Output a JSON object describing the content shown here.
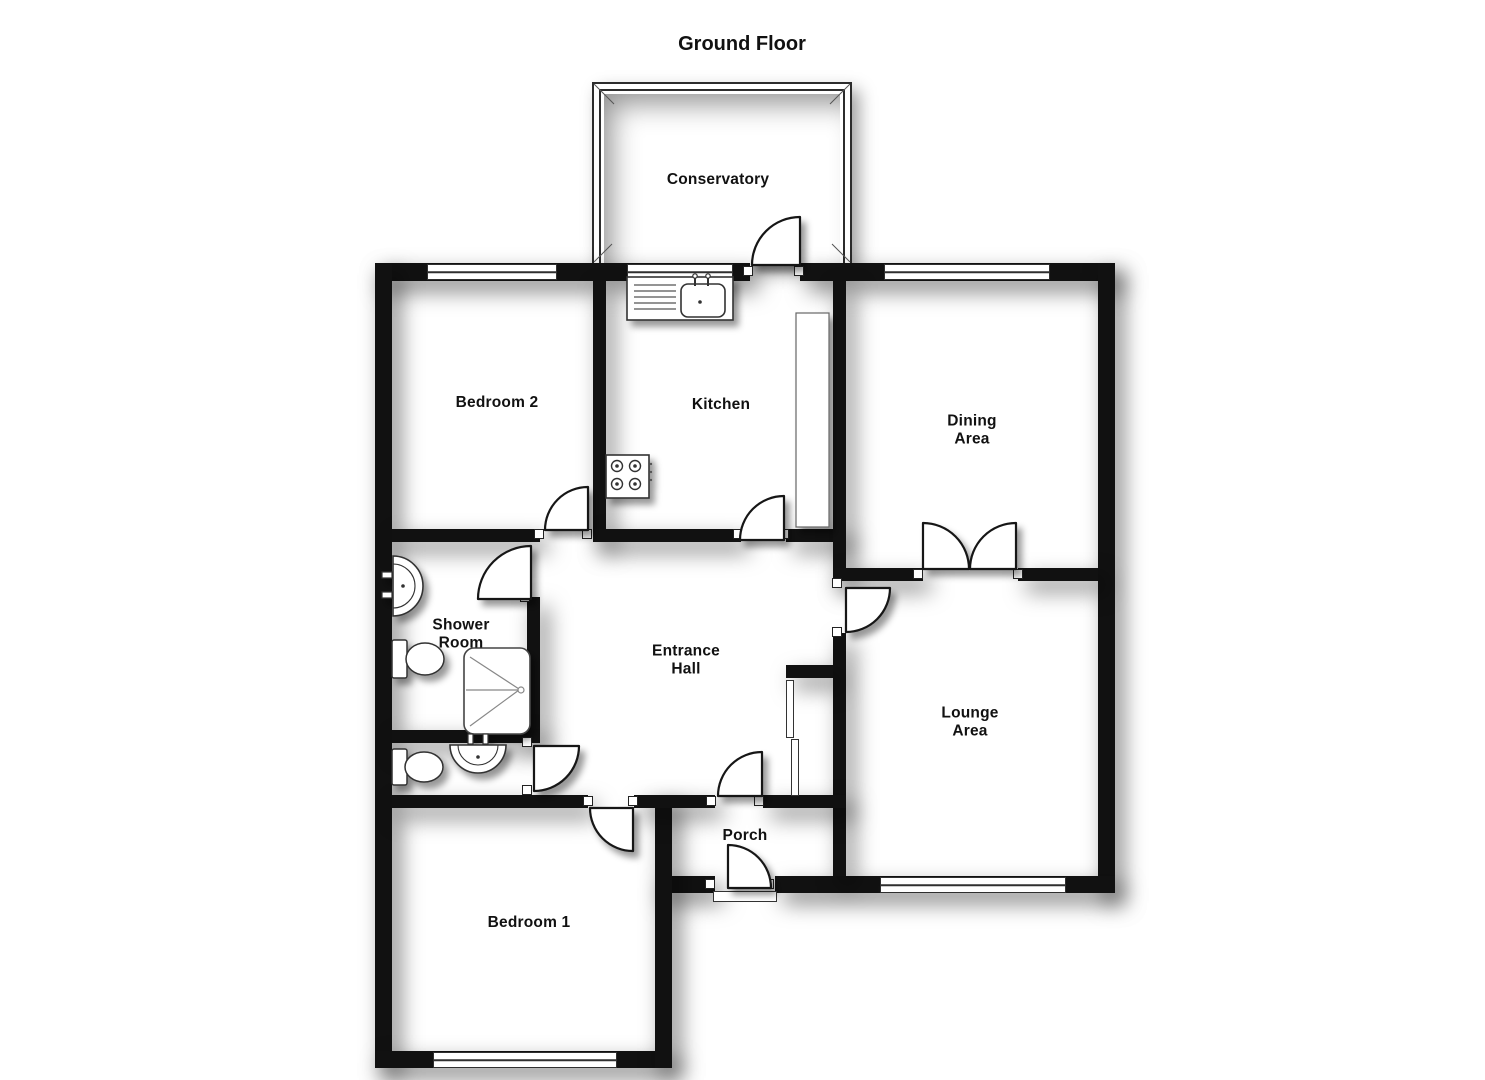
{
  "title": "Ground Floor",
  "plan": {
    "rooms": [
      {
        "name": "conservatory",
        "label": "Conservatory"
      },
      {
        "name": "bedroom-2",
        "label": "Bedroom 2"
      },
      {
        "name": "kitchen",
        "label": "Kitchen"
      },
      {
        "name": "dining-area",
        "label": "Dining\nArea"
      },
      {
        "name": "shower-room",
        "label": "Shower\nRoom"
      },
      {
        "name": "entrance-hall",
        "label": "Entrance\nHall"
      },
      {
        "name": "lounge-area",
        "label": "Lounge\nArea"
      },
      {
        "name": "porch",
        "label": "Porch"
      },
      {
        "name": "bedroom-1",
        "label": "Bedroom 1"
      }
    ],
    "fixtures": [
      {
        "icon": "sink-drainer-unit-icon",
        "room": "kitchen"
      },
      {
        "icon": "hob-4-burner-icon",
        "room": "kitchen"
      },
      {
        "icon": "worktop-counter",
        "room": "kitchen"
      },
      {
        "icon": "wash-basin-icon",
        "room": "shower-room"
      },
      {
        "icon": "toilet-icon",
        "room": "shower-room"
      },
      {
        "icon": "shower-tray-icon",
        "room": "shower-room"
      },
      {
        "icon": "toilet-icon",
        "room": "wc"
      },
      {
        "icon": "wash-basin-icon",
        "room": "wc"
      },
      {
        "icon": "storage-cupboard",
        "room": "entrance-hall"
      }
    ],
    "colors": {
      "wall": "#111111",
      "floor": "#ffffff",
      "line": "#333333",
      "shadow": "rgba(0,0,0,0.5)"
    }
  }
}
